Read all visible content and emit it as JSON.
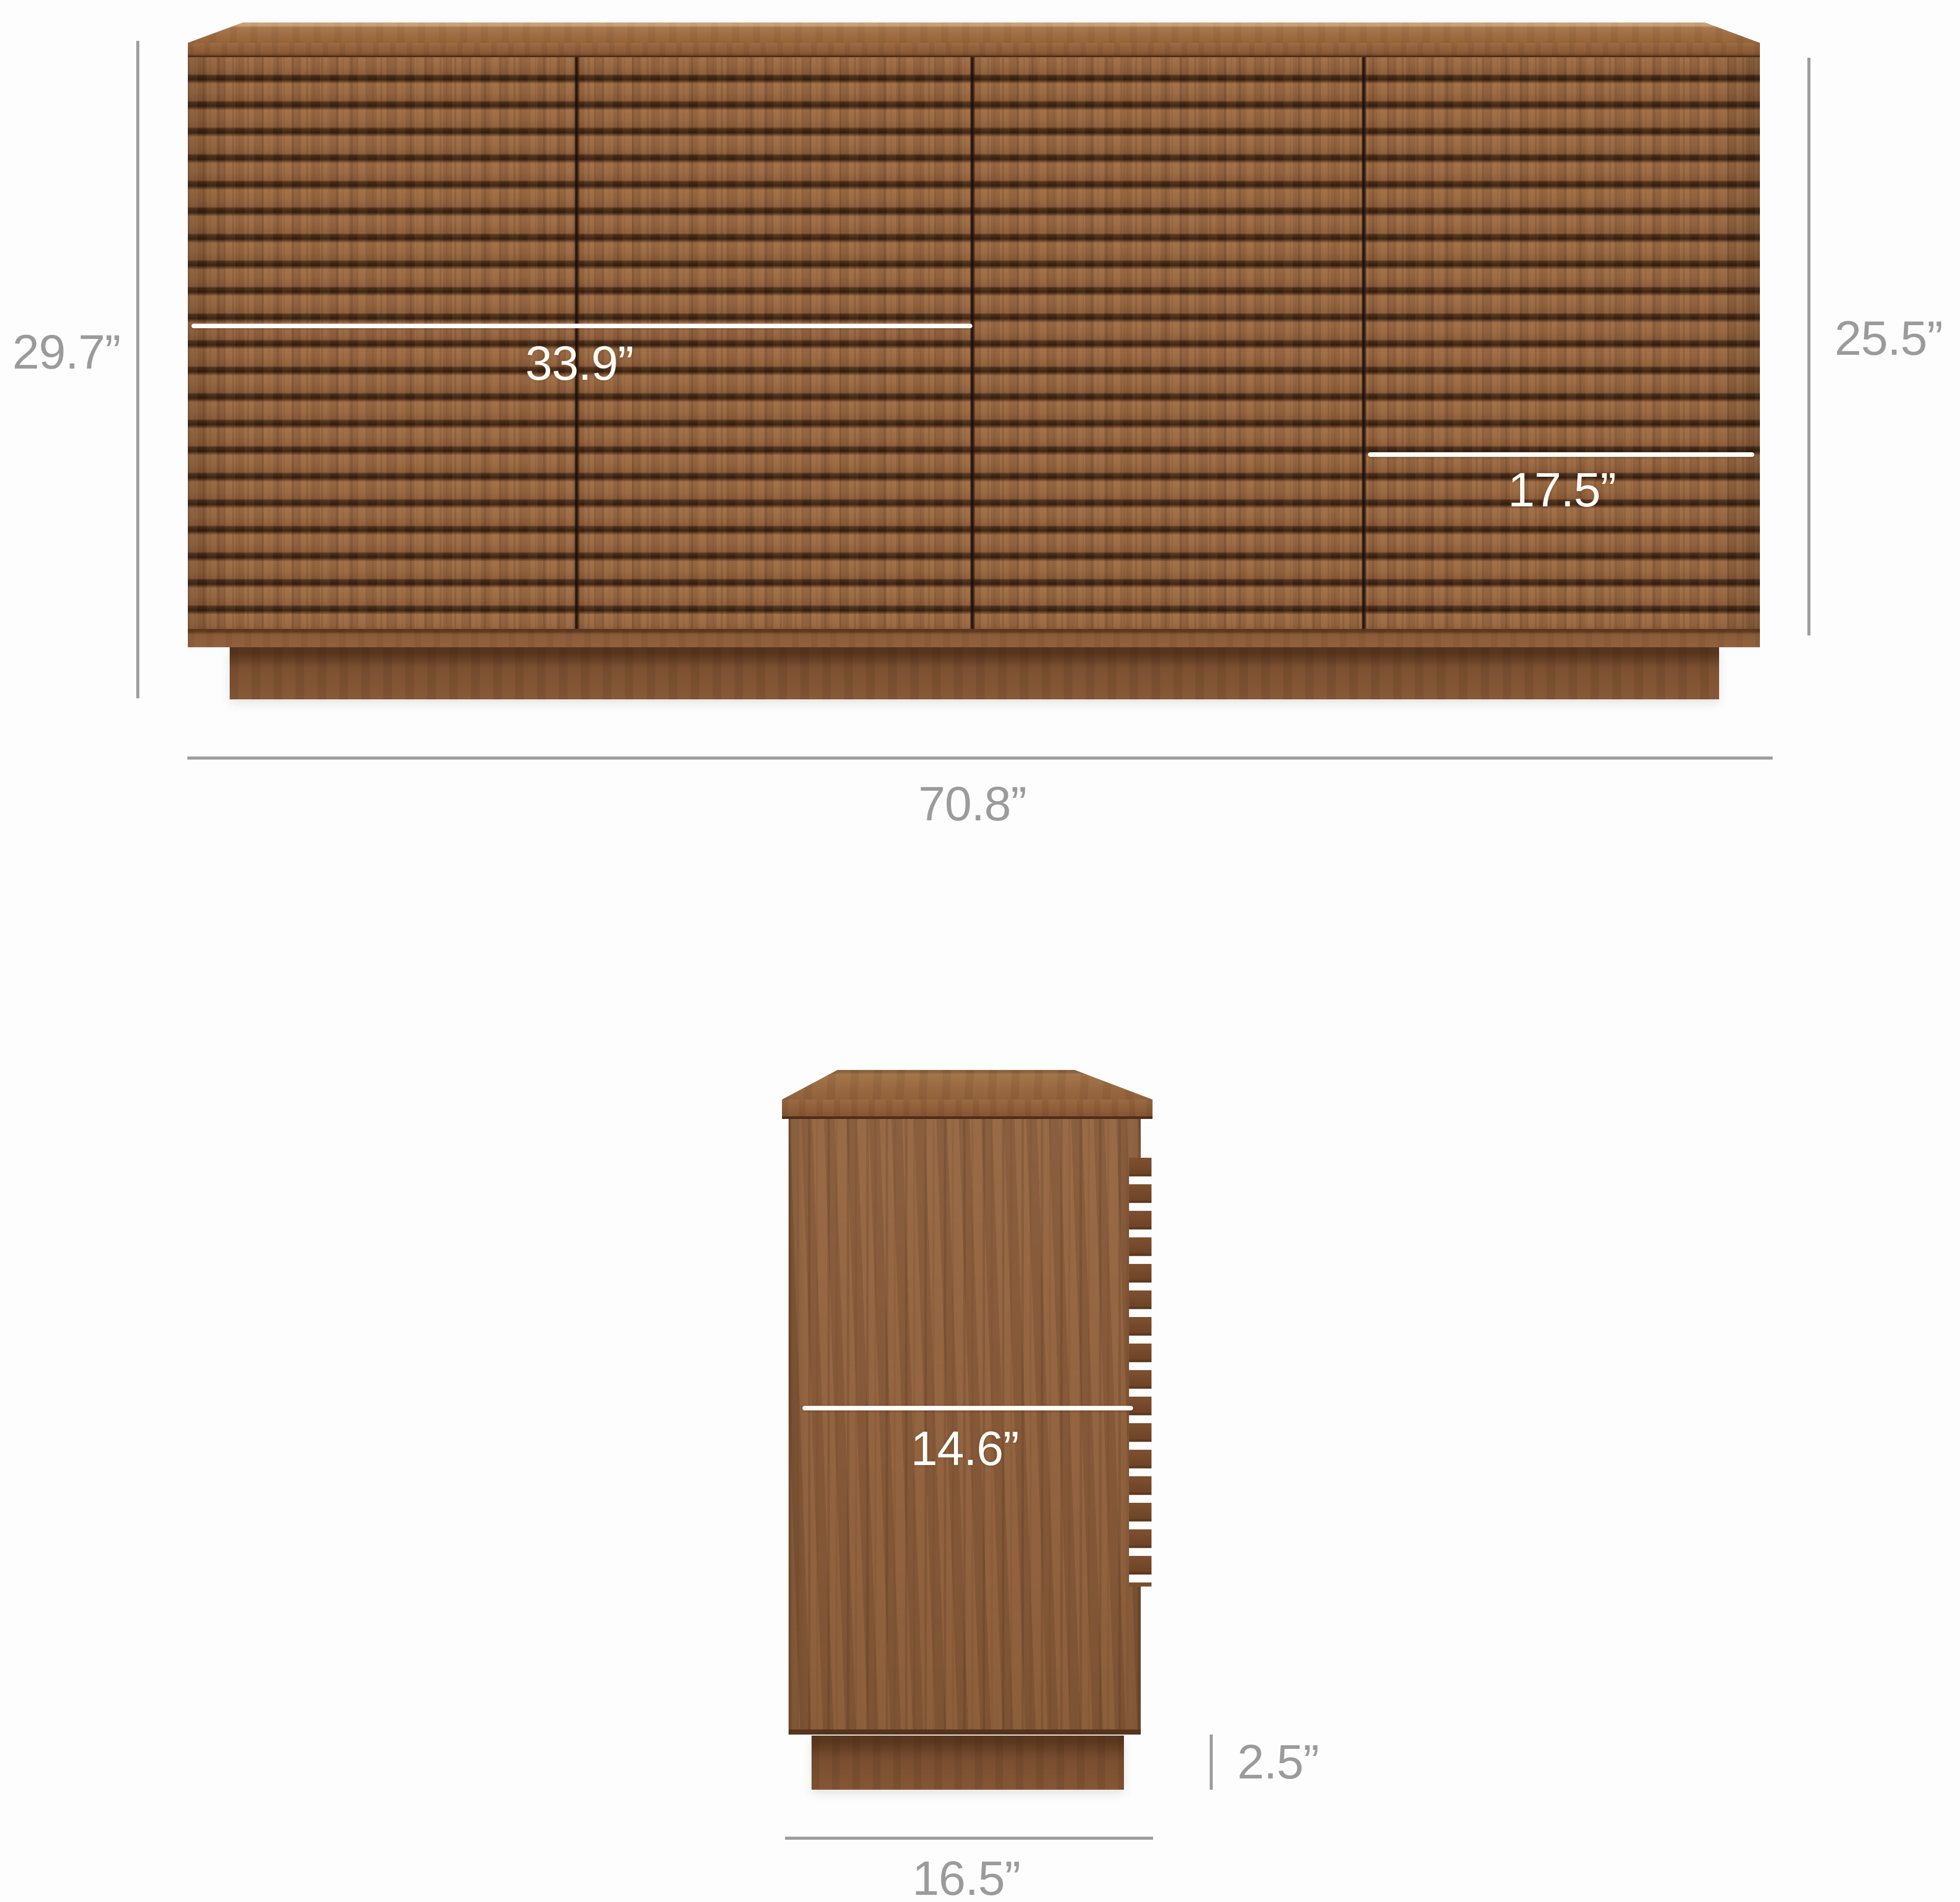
{
  "diagram": {
    "type": "furniture-dimension-diagram",
    "product": "slatted sideboard",
    "units": "inches"
  },
  "colors": {
    "background": "#fdfdfd",
    "wood_base": "#8d5e3b",
    "wood_slat_gap": "#3a2112",
    "dimension_gray": "#9b9b9b",
    "measure_white": "#fefcf8"
  },
  "front_view": {
    "overall_height_label": "29.7”",
    "door_height_label": "25.5”",
    "left_section_width_label": "33.9”",
    "door_width_label": "17.5”",
    "overall_width_label": "70.8”"
  },
  "side_view": {
    "interior_depth_label": "14.6”",
    "plinth_height_label": "2.5”",
    "overall_depth_label": "16.5”"
  }
}
